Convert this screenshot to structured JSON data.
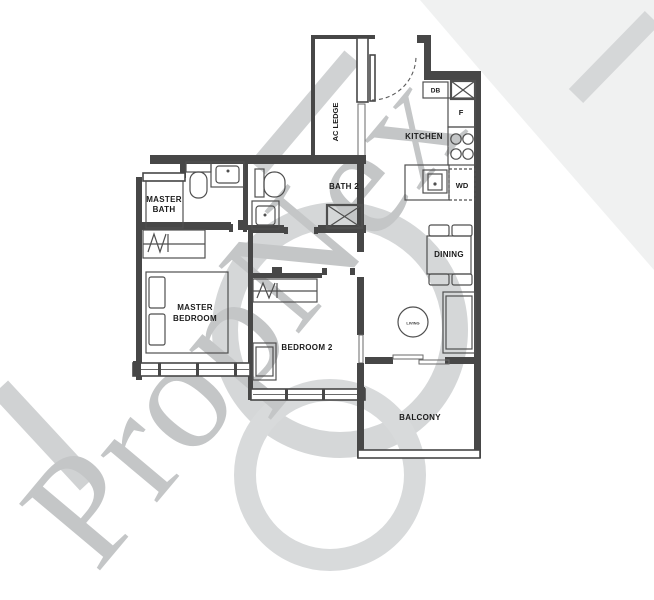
{
  "watermark": {
    "text": "PropNex",
    "color": "#c4c6c7",
    "swoosh_color": "#d5d7d8"
  },
  "colors": {
    "wall": "#474747",
    "fixture": "#4f4f4f",
    "label": "#1b1b1b",
    "background": "#ffffff"
  },
  "rooms": {
    "ac_ledge": {
      "label": "AC LEDGE"
    },
    "kitchen": {
      "label": "KITCHEN"
    },
    "bath2": {
      "label": "BATH 2"
    },
    "master_bath": {
      "line1": "MASTER",
      "line2": "BATH"
    },
    "master_bedroom": {
      "line1": "MASTER",
      "line2": "BEDROOM"
    },
    "bedroom2": {
      "label": "BEDROOM 2"
    },
    "dining": {
      "label": "DINING"
    },
    "living": {
      "label": "LIVING"
    },
    "balcony": {
      "label": "BALCONY"
    }
  },
  "appliances": {
    "db": "DB",
    "fridge": "F",
    "washer_dryer": "WD"
  }
}
